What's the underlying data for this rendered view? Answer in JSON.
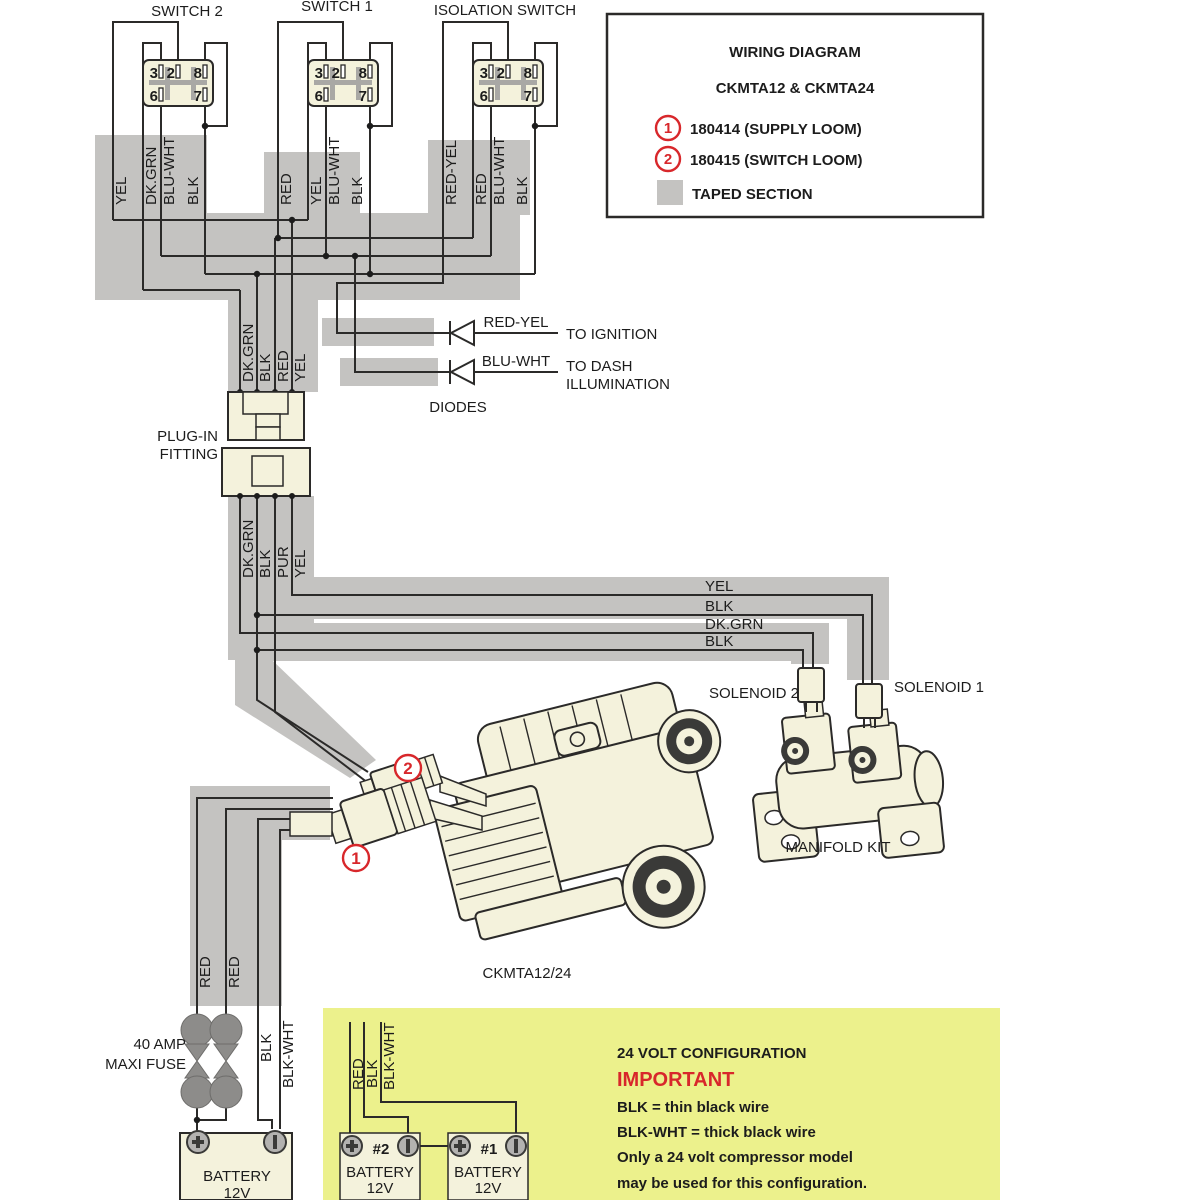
{
  "title_block": {
    "title": "WIRING DIAGRAM",
    "subtitle": "CKMTA12 & CKMTA24",
    "item1_num": "1",
    "item1_label": "180414 (SUPPLY LOOM)",
    "item2_num": "2",
    "item2_label": "180415 (SWITCH LOOM)",
    "taped_label": "TAPED SECTION"
  },
  "switches": [
    {
      "label": "SWITCH 2",
      "pins": [
        "3",
        "2",
        "8",
        "6",
        "7"
      ],
      "wires": [
        "YEL",
        "DK.GRN",
        "BLU-WHT",
        "BLK"
      ]
    },
    {
      "label": "SWITCH 1",
      "pins": [
        "3",
        "2",
        "8",
        "6",
        "7"
      ],
      "wires": [
        "RED",
        "YEL",
        "BLU-WHT",
        "BLK"
      ]
    },
    {
      "label": "ISOLATION SWITCH",
      "pins": [
        "3",
        "2",
        "8",
        "6",
        "7"
      ],
      "wires": [
        "RED-YEL",
        "RED",
        "BLU-WHT",
        "BLK"
      ]
    }
  ],
  "diodes": {
    "caption": "DIODES",
    "row1_wire": "RED-YEL",
    "row1_target": "TO IGNITION",
    "row2_wire": "BLU-WHT",
    "row2_target1": "TO DASH",
    "row2_target2": "ILLUMINATION"
  },
  "plug_fitting": {
    "label1": "PLUG-IN",
    "label2": "FITTING",
    "wires_in": [
      "DK.GRN",
      "BLK",
      "RED",
      "YEL"
    ],
    "wires_out": [
      "DK.GRN",
      "BLK",
      "PUR",
      "YEL"
    ]
  },
  "harness": {
    "wires": [
      "YEL",
      "BLK",
      "DK.GRN",
      "BLK"
    ]
  },
  "manifold": {
    "solenoid2": "SOLENOID 2",
    "solenoid1": "SOLENOID 1",
    "caption": "MANIFOLD KIT"
  },
  "compressor": {
    "caption": "CKMTA12/24"
  },
  "markers": {
    "supply": "1",
    "switch_loom": "2"
  },
  "supply": {
    "fuse_label1": "40 AMP",
    "fuse_label2": "MAXI FUSE",
    "wires": [
      "RED",
      "RED",
      "BLK",
      "BLK-WHT"
    ]
  },
  "battery_main": {
    "name": "BATTERY",
    "volt": "12V"
  },
  "config24": {
    "title": "24 VOLT CONFIGURATION",
    "important": "IMPORTANT",
    "line1": "BLK = thin black wire",
    "line2": "BLK-WHT = thick black wire",
    "line3": "Only a 24 volt compressor model",
    "line4": "may be used for this configuration.",
    "wires": [
      "RED",
      "BLK",
      "BLK-WHT"
    ],
    "bat2_num": "#2",
    "bat1_num": "#1",
    "bat_name": "BATTERY",
    "bat_volt": "12V"
  },
  "colors": {
    "accent_red": "#d8272b",
    "taped_gray": "#c4c3c1",
    "component_cream": "#f4f2dc",
    "panel_yellow": "#ecf18c"
  }
}
